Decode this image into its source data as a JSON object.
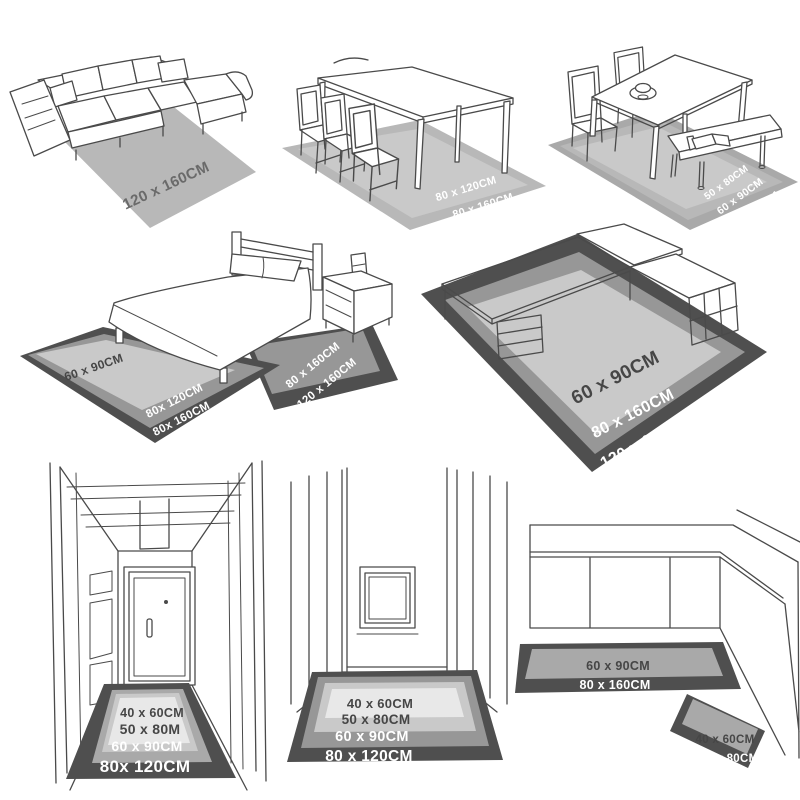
{
  "palette": {
    "line": "#4a4a4a",
    "rug_dark": "#4f4f4f",
    "rug_gray": "#979797",
    "rug_gray2": "#a9a9a9",
    "rug_mid": "#b8b8b8",
    "rug_light": "#c9c9c9",
    "rug_xlight": "#e8e8e8",
    "label_dark": "#464646",
    "label_gray": "#6a6a6a",
    "label_white": "#ffffff"
  },
  "scenes": {
    "living_room": {
      "rug_labels": [
        "120 x 160CM"
      ]
    },
    "dining_room": {
      "rug_labels": [
        "80 x 120CM",
        "80 x 160CM"
      ]
    },
    "dining_bench": {
      "rug_labels": [
        "50 x 80CM",
        "60 x 90CM",
        "80x 120CM"
      ]
    },
    "bedroom": {
      "foot_rug_labels": [
        "60 x 90CM",
        "80x 120CM",
        "80x 160CM"
      ],
      "side_rug_labels": [
        "80 x 160CM",
        "120 x 160CM"
      ]
    },
    "office": {
      "rug_labels": [
        "60 x 90CM",
        "80 x 160CM",
        "120 x 160CM"
      ]
    },
    "hallway": {
      "rug_labels": [
        "40 x 60CM",
        "50 x 80M",
        "60 x 90CM",
        "80x 120CM"
      ]
    },
    "entryway": {
      "rug_labels": [
        "40 x 60CM",
        "50 x 80CM",
        "60 x 90CM",
        "80 x 120CM"
      ]
    },
    "kitchen": {
      "runner_labels": [
        "60 x 90CM",
        "80 x 160CM"
      ],
      "mat_labels": [
        "40 x 60CM",
        "50 x 80CM"
      ]
    }
  }
}
